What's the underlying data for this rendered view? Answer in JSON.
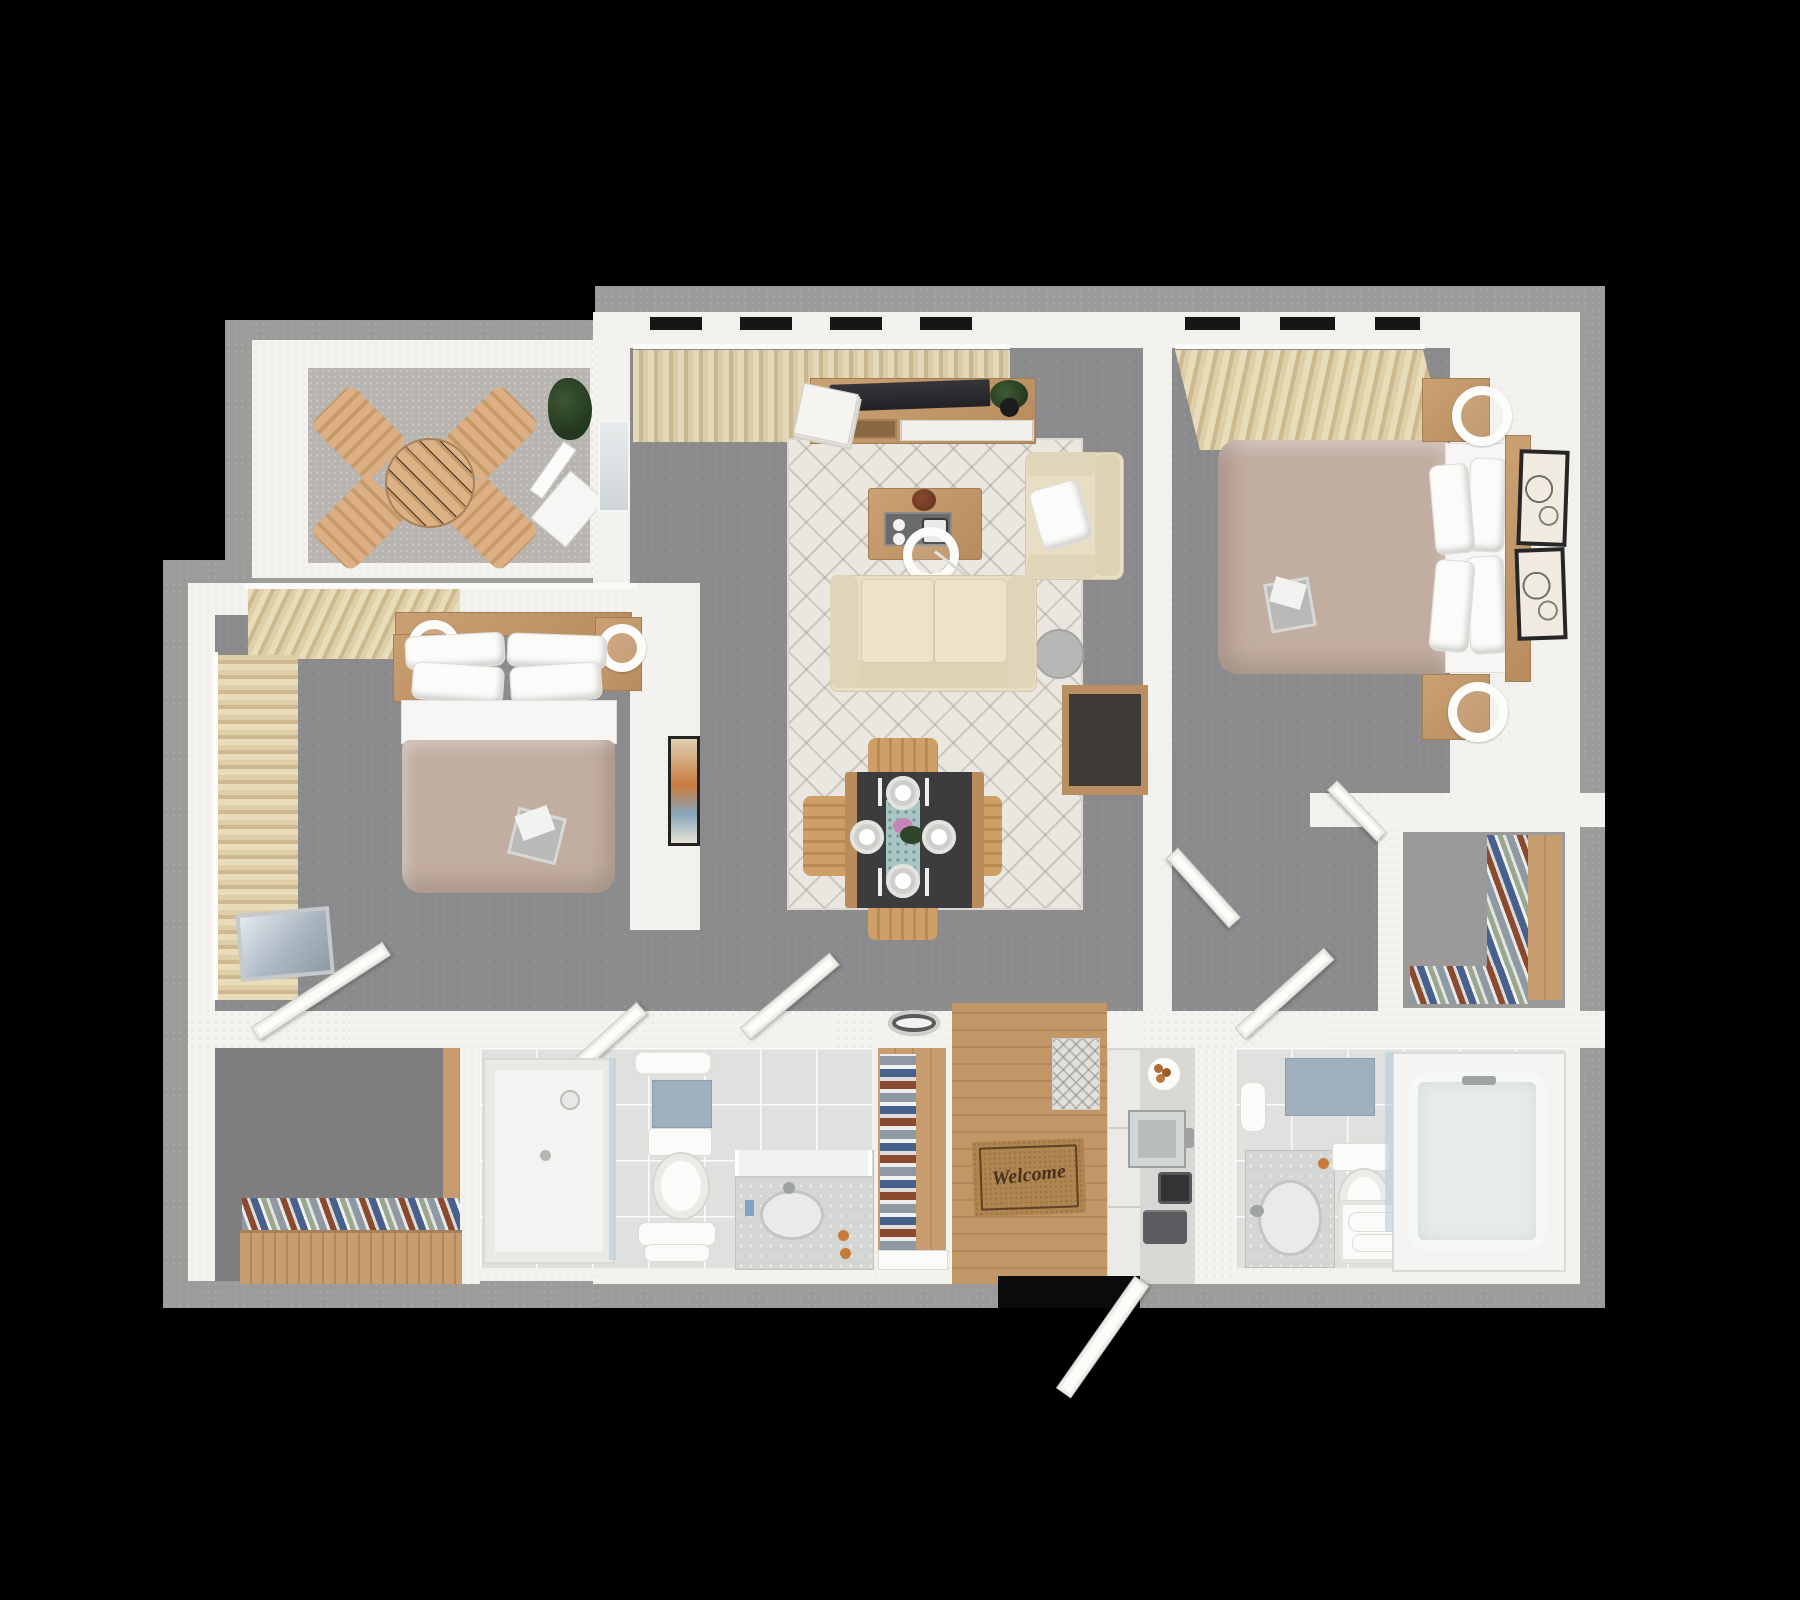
{
  "scene": {
    "type": "3d-floor-plan-top-view",
    "background_color": "#000000"
  },
  "entry": {
    "welcome_mat_text": "Welcome",
    "floor": "hardwood",
    "items": [
      "welcome-mat",
      "runner-rug",
      "front-door"
    ]
  },
  "palette": {
    "outer_wall_gray": "#9c9b99",
    "wall_white": "#f4f2ee",
    "carpet_gray": "#8b8b8e",
    "closet_carpet_dark": "#7e7e81",
    "balcony_floor": "#b8b5b1",
    "tile_floor": "#e0e1df",
    "wood_light": "#c49a6c",
    "curtain_beige": "#ddcba4",
    "sofa_cream": "#e7dec3",
    "rug_cream": "#eae7e0",
    "duvet_taupe": "#c2ada1",
    "dining_table_dark": "#3c3b3d",
    "welcome_mat_tan": "#b0854f",
    "bath_mat_blue": "#a0afbc"
  },
  "rooms": {
    "balcony": {
      "label": "Balcony",
      "items": [
        "round-bistro-table",
        "folding-chair x4",
        "potted-plant",
        "leaning-folded-chair",
        "balcony-door"
      ]
    },
    "living_room": {
      "label": "Living Room",
      "items": [
        "window-curtains",
        "tv-console",
        "tv",
        "magazines",
        "plant",
        "area-rug",
        "coffee-table",
        "arc-floor-lamp",
        "sofa",
        "armchair",
        "bar-cabinet",
        "wall-art",
        "ceiling-light"
      ]
    },
    "dining_area": {
      "label": "Dining Area",
      "items": [
        "dining-table",
        "wood-chair x4",
        "plate x4",
        "table-runner",
        "flowers"
      ]
    },
    "bedroom_1": {
      "label": "Bedroom 1",
      "items": [
        "double-bed",
        "pillow x4",
        "headboard-shelf",
        "nightstand x2",
        "fan x2",
        "curtains",
        "leaning-mirror",
        "door x2"
      ]
    },
    "bedroom_2": {
      "label": "Bedroom 2",
      "items": [
        "double-bed",
        "pillow x4",
        "headboard",
        "nightstand x2",
        "ring-lamp x2",
        "curtains",
        "wall-art x2",
        "walk-in-closet",
        "door x2"
      ]
    },
    "bathroom_1": {
      "label": "Bathroom 1",
      "items": [
        "shower",
        "glass-panel",
        "toilet",
        "vanity-sink",
        "towels",
        "bath-mat"
      ]
    },
    "bathroom_2": {
      "label": "Bathroom 2",
      "items": [
        "bathtub",
        "glass-screen",
        "toilet",
        "vanity-sink",
        "towel-bench",
        "towel-roll",
        "bath-mat"
      ]
    },
    "walk_in_closet": {
      "label": "Walk-in Closet",
      "items": [
        "wardrobe-dresser",
        "folded-clothes"
      ]
    },
    "linen_closet": {
      "label": "Linen Closet",
      "items": [
        "wood-shelves",
        "folded-linens"
      ]
    },
    "kitchenette": {
      "label": "Kitchenette / Laundry",
      "items": [
        "cabinets",
        "sink",
        "coffee-maker",
        "pastry-plate",
        "trash-bin"
      ]
    }
  }
}
